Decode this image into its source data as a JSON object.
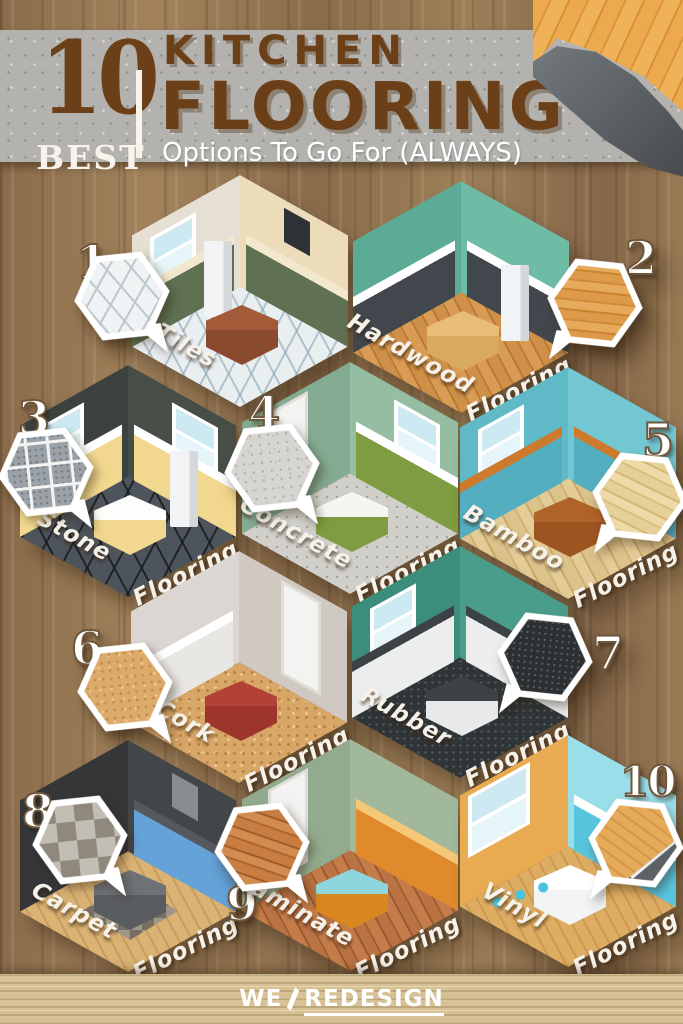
{
  "header": {
    "count": "10",
    "count_label": "BEST",
    "title_line1": "KITCHEN",
    "title_line2": "FLOORING",
    "subtitle": "Options To Go For (ALWAYS)",
    "accent_color": "#6b4019",
    "banner_color": "#b3b2ae"
  },
  "items": [
    {
      "number": "1",
      "label": "Tiles",
      "words": [
        "Tiles"
      ],
      "swatch": "white-ceramic-tile-grid"
    },
    {
      "number": "2",
      "label": "Hardwood Flooring",
      "words": [
        "Hardwood",
        "Flooring"
      ],
      "swatch": "orange-wood-planks"
    },
    {
      "number": "3",
      "label": "Stone Flooring",
      "words": [
        "Stone",
        "Flooring"
      ],
      "swatch": "grey-stone-tiles"
    },
    {
      "number": "4",
      "label": "Concrete Flooring",
      "words": [
        "Concrete",
        "Flooring"
      ],
      "swatch": "speckled-concrete"
    },
    {
      "number": "5",
      "label": "Bamboo Flooring",
      "words": [
        "Bamboo",
        "Flooring"
      ],
      "swatch": "light-bamboo-planks"
    },
    {
      "number": "6",
      "label": "Cork Flooring",
      "words": [
        "Cork",
        "Flooring"
      ],
      "swatch": "cork-grain"
    },
    {
      "number": "7",
      "label": "Rubber Flooring",
      "words": [
        "Rubber",
        "Flooring"
      ],
      "swatch": "black-rubber-speckle"
    },
    {
      "number": "8",
      "label": "Carpet Flooring",
      "words": [
        "Carpet",
        "Flooring"
      ],
      "swatch": "chequered-carpet-tiles"
    },
    {
      "number": "9",
      "label": "Laminate Flooring",
      "words": [
        "Laminate",
        "Flooring"
      ],
      "swatch": "red-brown-laminate"
    },
    {
      "number": "10",
      "label": "Vinyl Flooring",
      "words": [
        "Vinyl",
        "Flooring"
      ],
      "swatch": "vinyl-wood-sheet-peel"
    }
  ],
  "footer": {
    "brand_first": "WE",
    "brand_second": "REDESIGN"
  }
}
